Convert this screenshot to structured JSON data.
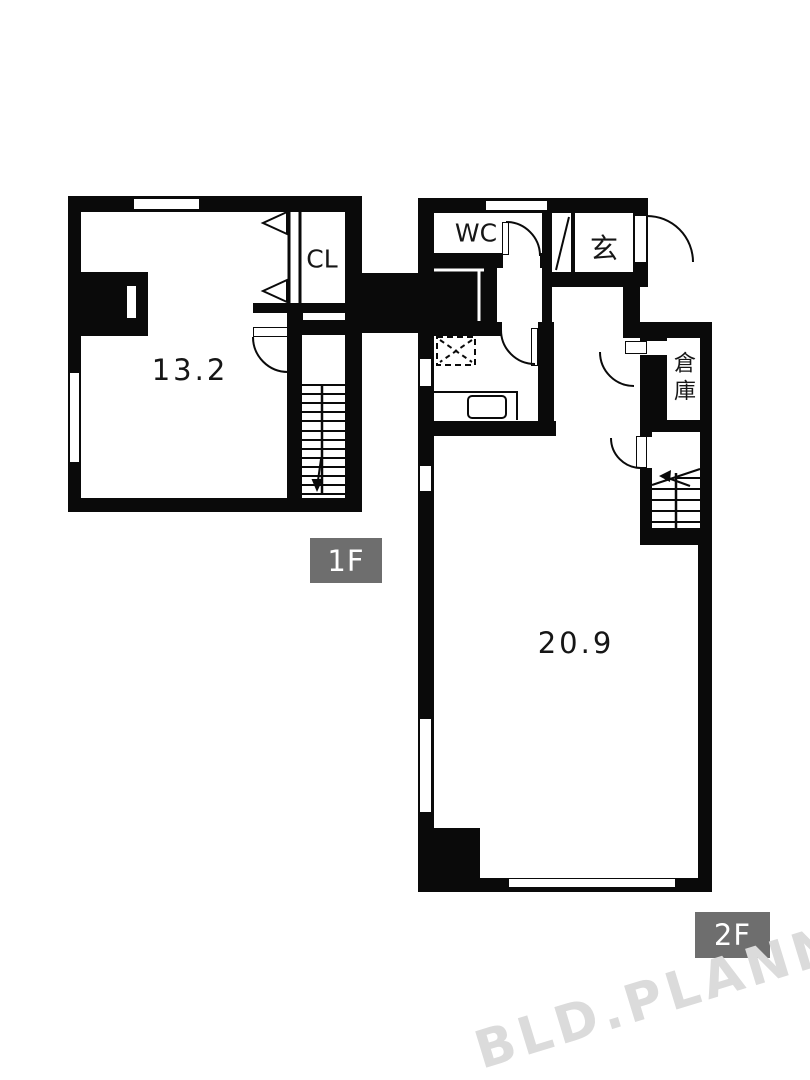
{
  "floors": [
    {
      "badge": "1F",
      "area_tatami": "13.2",
      "rooms": [
        {
          "label": "CL"
        }
      ]
    },
    {
      "badge": "2F",
      "area_tatami": "20.9",
      "rooms": [
        {
          "label": "WC"
        },
        {
          "label": "玄"
        },
        {
          "label": "倉庫"
        }
      ]
    }
  ],
  "watermark": "BLD.PLANNER",
  "colors": {
    "wall": "#0a0a0a",
    "line": "#0a0a0a",
    "badge_bg": "#6e6e6e",
    "badge_text": "#ffffff",
    "watermark": "#dbdbdb",
    "paper": "#ffffff"
  }
}
